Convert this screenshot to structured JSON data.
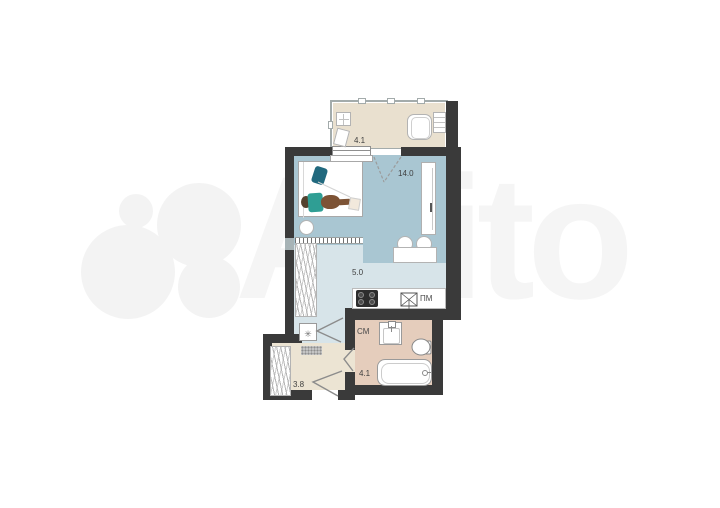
{
  "watermark": {
    "brand_text": "Avito"
  },
  "plan": {
    "rooms": {
      "balcony": {
        "name": "balcony",
        "area": "4.1"
      },
      "living_room": {
        "name": "living room",
        "area": "14.0"
      },
      "kitchen": {
        "name": "kitchen",
        "area": "5.0"
      },
      "hallway": {
        "name": "hallway",
        "area": "3.8"
      },
      "bathroom": {
        "name": "bathroom",
        "area": "4.1"
      }
    },
    "labels": {
      "dishwasher": "ПМ",
      "washing_machine": "СМ"
    },
    "symbols": {
      "fridge_snowflake": "✳"
    },
    "colors": {
      "wall": "#3a3a3a",
      "living_floor": "#a9c6d2",
      "kitchen_floor": "#d7e4e9",
      "balcony_floor": "#e9e0cf",
      "hallway_floor": "#ece4d3",
      "bathroom_floor": "#e5cdbc"
    }
  }
}
